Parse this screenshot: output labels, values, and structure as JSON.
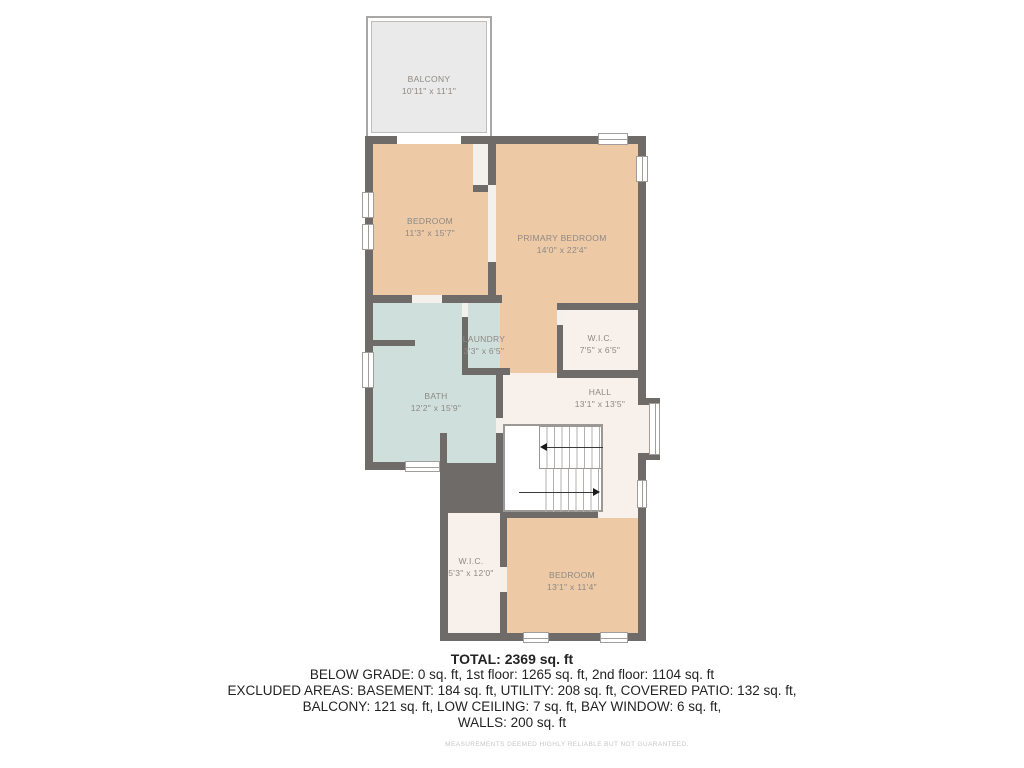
{
  "plan": {
    "colors": {
      "wall": "#6f6b69",
      "tan": "#edc9a6",
      "blue": "#cfdfdc",
      "cream": "#f8f0ea",
      "gap": "#f4f0ec",
      "balcony": "#eaeaea",
      "label": "#8d8984",
      "winline": "#a09d9a",
      "stairline": "#b3b1ae",
      "stairborder": "#9b9896",
      "footer": "#232323",
      "muted": "#c9c7c4"
    },
    "rooms": [
      {
        "id": "balcony",
        "name": "BALCONY",
        "dims": "10'11\" x 11'1\""
      },
      {
        "id": "bedroom-upper",
        "name": "BEDROOM",
        "dims": "11'3\" x 15'7\""
      },
      {
        "id": "primary-bedroom",
        "name": "PRIMARY BEDROOM",
        "dims": "14'0\" x 22'4\""
      },
      {
        "id": "laundry",
        "name": "LAUNDRY",
        "dims": "3'3\" x 6'5\""
      },
      {
        "id": "wic-upper",
        "name": "W.I.C.",
        "dims": "7'5\" x 6'5\""
      },
      {
        "id": "bath",
        "name": "BATH",
        "dims": "12'2\" x 15'9\""
      },
      {
        "id": "hall",
        "name": "HALL",
        "dims": "13'1\" x 13'5\""
      },
      {
        "id": "wic-lower",
        "name": "W.I.C.",
        "dims": "5'3\" x 12'0\""
      },
      {
        "id": "bedroom-lower",
        "name": "BEDROOM",
        "dims": "13'1\" x 11'4\""
      }
    ]
  },
  "footer": {
    "total": "TOTAL: 2369 sq. ft",
    "lines": [
      "BELOW GRADE: 0 sq. ft, 1st floor: 1265 sq. ft, 2nd floor: 1104 sq. ft",
      "EXCLUDED AREAS: BASEMENT: 184 sq. ft, UTILITY: 208 sq. ft, COVERED PATIO: 132 sq. ft,",
      "BALCONY: 121 sq. ft, LOW CEILING: 7 sq. ft, BAY WINDOW: 6 sq. ft,",
      "WALLS: 200 sq. ft"
    ],
    "disclaimer": "MEASUREMENTS DEEMED HIGHLY RELIABLE BUT NOT GUARANTEED."
  }
}
